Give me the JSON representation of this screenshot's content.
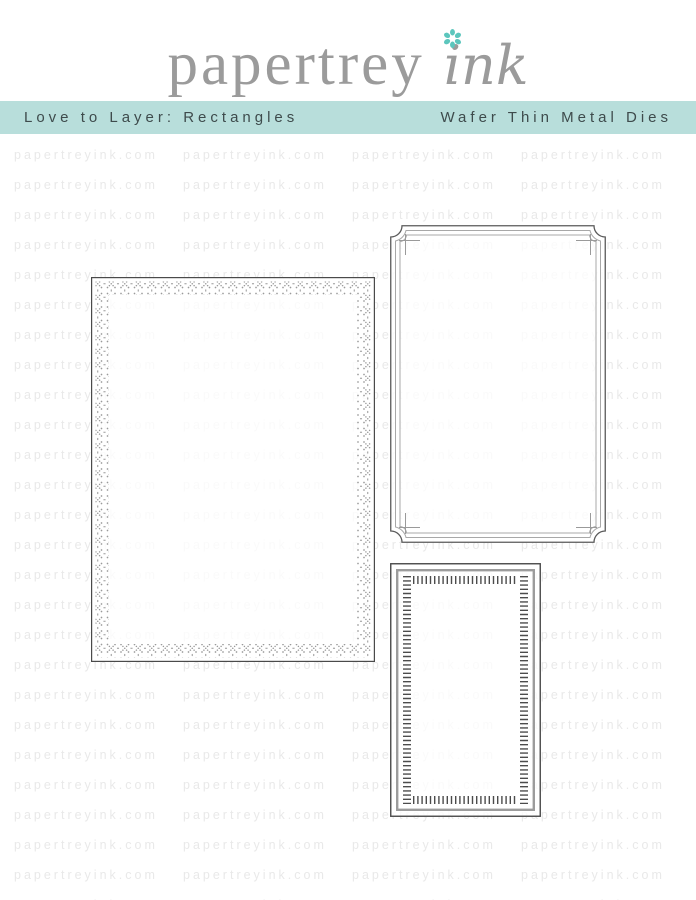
{
  "logo": {
    "brand_serif": "papertrey",
    "brand_script": "ink",
    "text_color": "#9b9b9b",
    "flower_color": "#5cc6bd"
  },
  "banner": {
    "left_label": "Love to Layer: Rectangles",
    "right_label": "Wafer Thin Metal Dies",
    "background": "#b8dedb",
    "text_color": "#3e4b4c"
  },
  "watermark": {
    "text": "papertreyink.com",
    "color": "#e9e9e9",
    "rows": 26,
    "columns": 4
  },
  "dies": {
    "cross_stitch_rectangle": "cross-stitch-border-rectangle-die",
    "ticket_corner_frame": "ticket-corner-double-frame-die",
    "ladder_stitch_rectangle": "ladder-stitch-border-rectangle-die",
    "outline_color": "#4a4a4a",
    "detail_color": "#9c9c9c"
  }
}
